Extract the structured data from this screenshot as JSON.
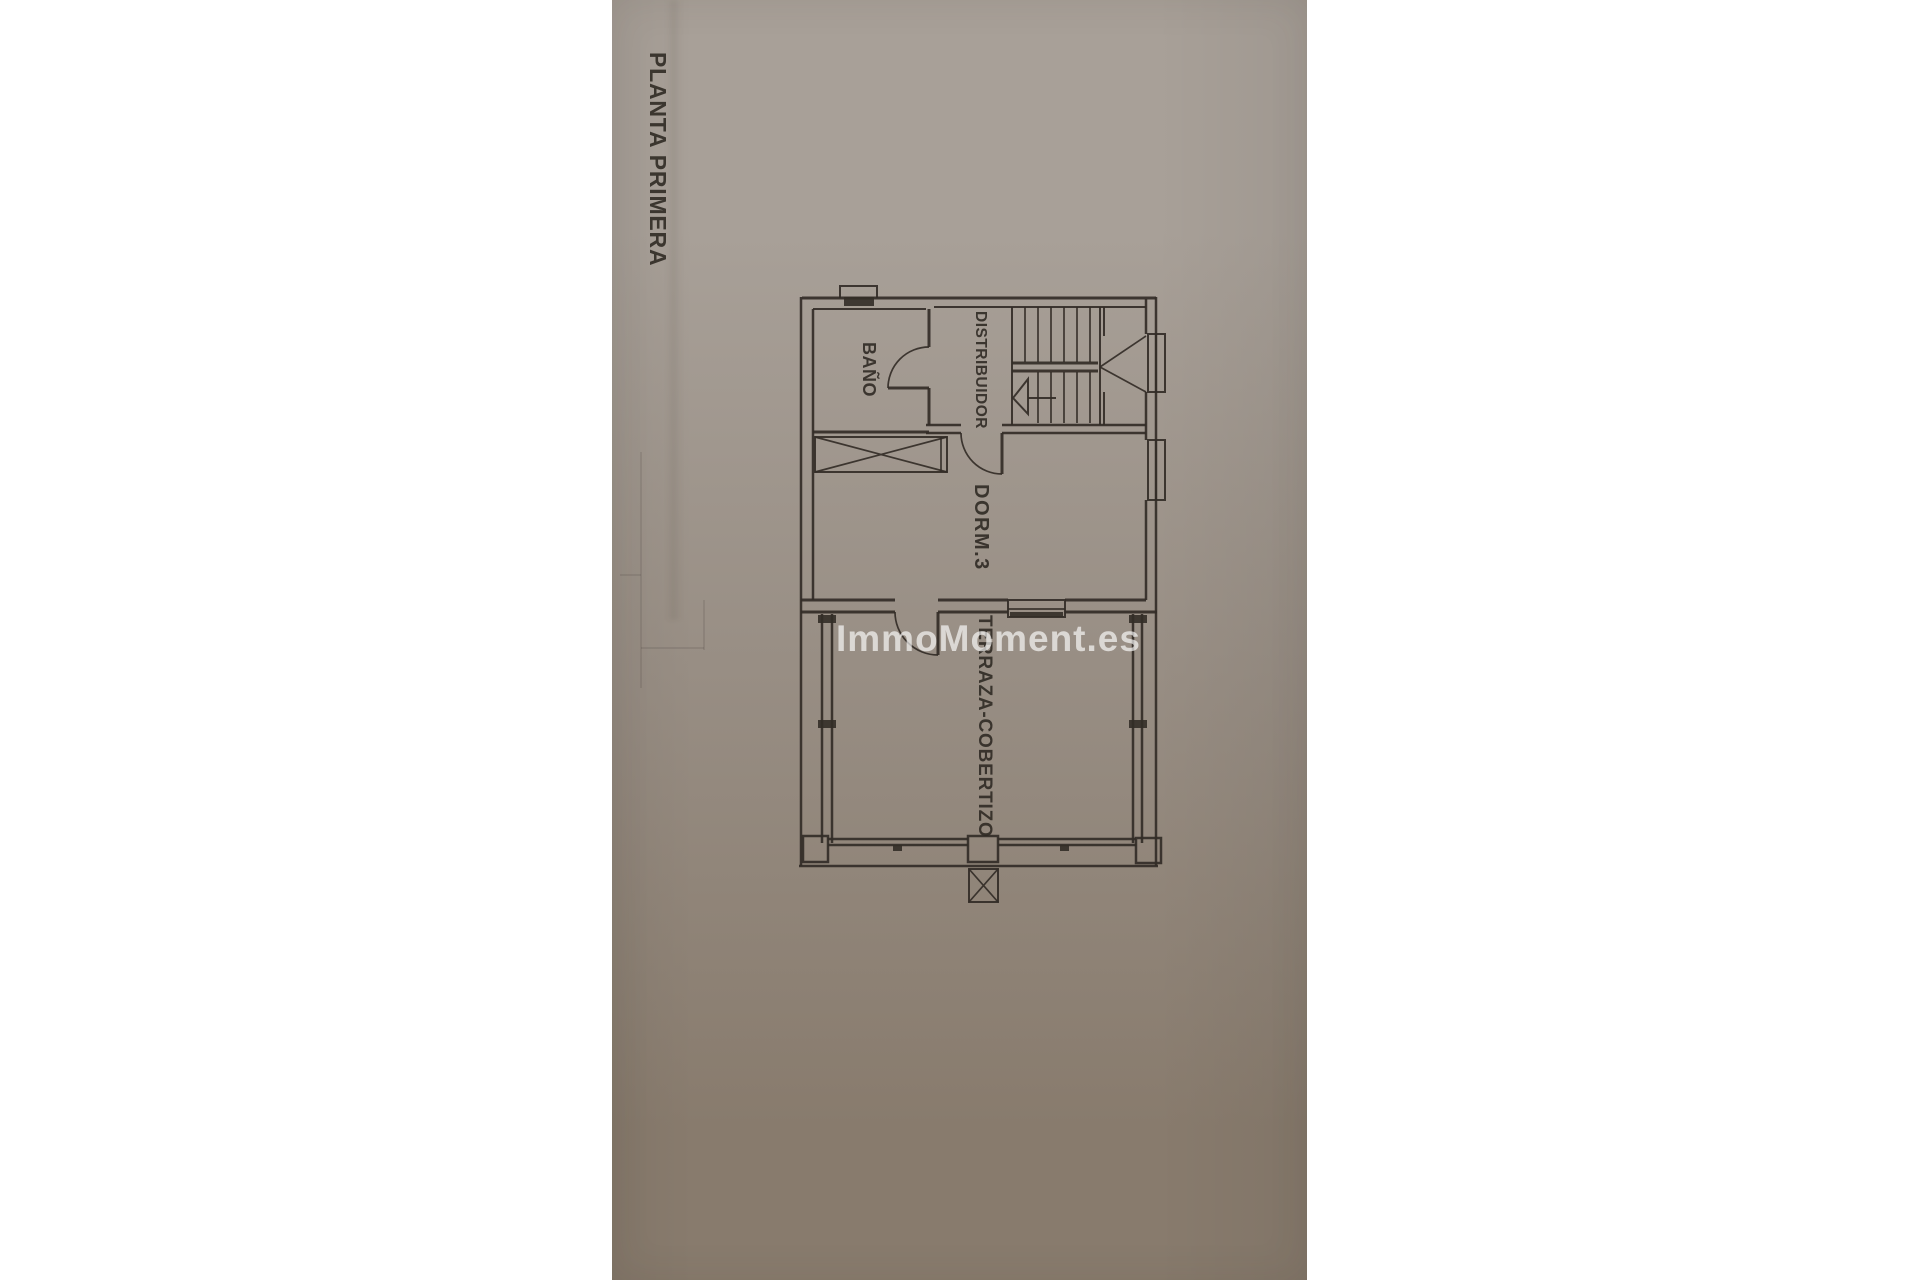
{
  "photo": {
    "background": "#ffffff"
  },
  "paper": {
    "color_top": "#a8a098",
    "color_mid": "#988e84",
    "color_bottom": "#887b6d"
  },
  "plan": {
    "title": "PLANTA PRIMERA",
    "watermark": "ImmoMoment.es",
    "rooms": [
      {
        "label": "BAÑO"
      },
      {
        "label": "DISTRIBUIDOR"
      },
      {
        "label": "DORM.3"
      },
      {
        "label": "TERRAZA-COBERTIZO"
      }
    ],
    "colors": {
      "ink": "#332d27",
      "label": "#2d2822",
      "watermark": "rgba(255,255,255,0.65)"
    }
  }
}
